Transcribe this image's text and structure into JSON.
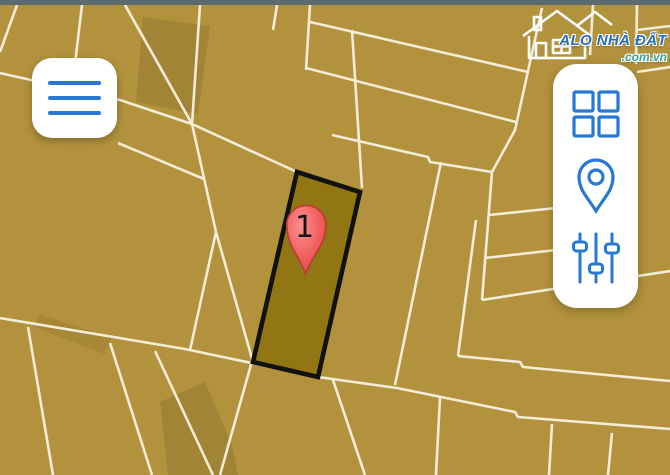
{
  "app": {
    "brand": {
      "name": "ALO NHÀ ĐẤT",
      "domain": ".com.vn"
    },
    "colors": {
      "map_bg": "#b2923c",
      "parcel_line": "#f3ecd6",
      "highlight_fill": "#927613",
      "highlight_border": "#111111",
      "accent_blue": "#2778d4",
      "marker_red": "#ef5656",
      "top_bar": "#5a6a70",
      "logo_blue": "#2a6db8",
      "logo_teal": "#35a49e"
    }
  },
  "map": {
    "marker": {
      "label": "1"
    }
  },
  "controls": {
    "menu_button_icon": "hamburger-icon",
    "panel_icons": [
      "grid-icon",
      "location-pin-icon",
      "filters-icon"
    ]
  }
}
